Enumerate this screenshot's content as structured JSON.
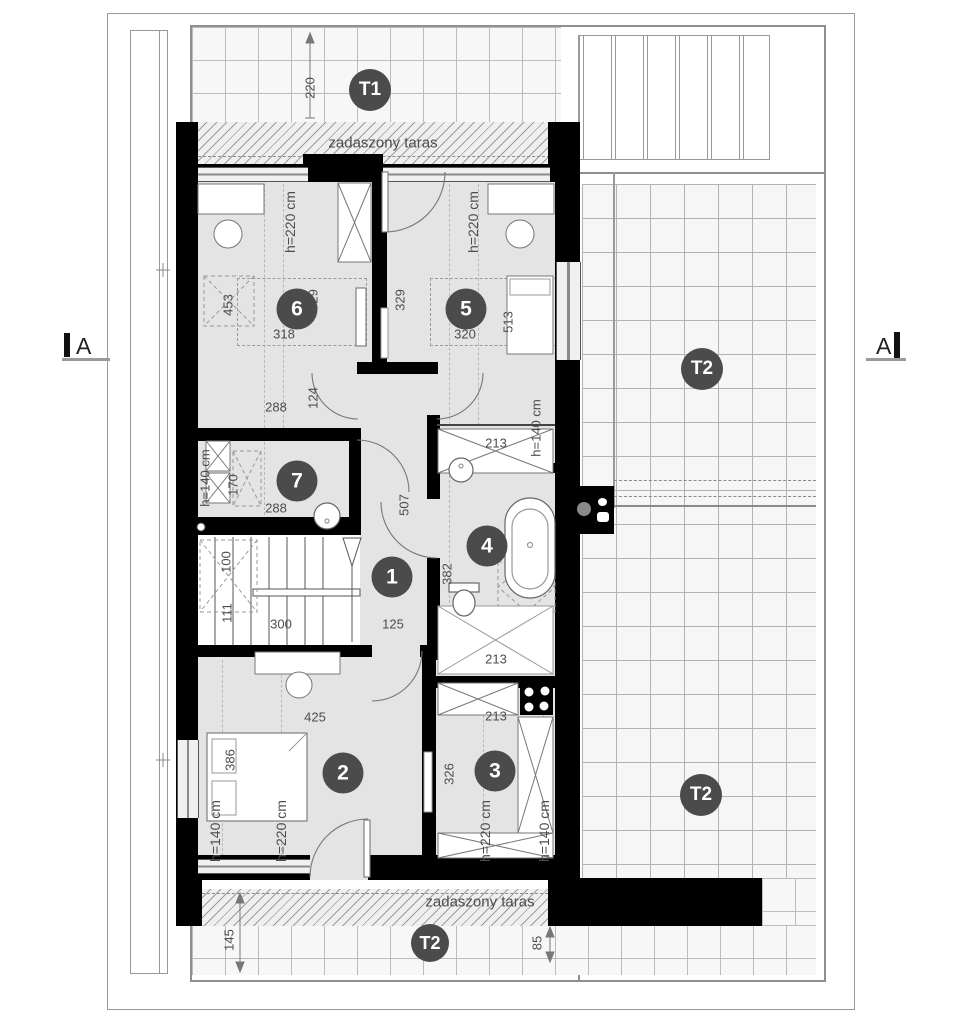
{
  "plan_title": "attic floor plan",
  "colors": {
    "wall": "#000000",
    "badge": "#4b4b4b",
    "dim_text": "#4d4d4d",
    "floor": "#e4e4e4",
    "terrace_grid": "#bcbcbc"
  },
  "section_markers": {
    "left": "A",
    "right": "A"
  },
  "badges": [
    {
      "n": "badge-terrace-t1",
      "t": "T1",
      "x": 370,
      "y": 90,
      "d": 42,
      "fs": 19
    },
    {
      "n": "badge-terrace-t2-upper",
      "t": "T2",
      "x": 702,
      "y": 369,
      "d": 42,
      "fs": 19
    },
    {
      "n": "badge-terrace-t2-lower",
      "t": "T2",
      "x": 701,
      "y": 795,
      "d": 42,
      "fs": 19
    },
    {
      "n": "badge-terrace-t2-bottom",
      "t": "T2",
      "x": 430,
      "y": 943,
      "d": 38,
      "fs": 18
    },
    {
      "n": "badge-room-1",
      "t": "1",
      "x": 392,
      "y": 577,
      "d": 41,
      "fs": 21
    },
    {
      "n": "badge-room-2",
      "t": "2",
      "x": 343,
      "y": 773,
      "d": 41,
      "fs": 21
    },
    {
      "n": "badge-room-3",
      "t": "3",
      "x": 495,
      "y": 771,
      "d": 41,
      "fs": 21
    },
    {
      "n": "badge-room-4",
      "t": "4",
      "x": 487,
      "y": 546,
      "d": 41,
      "fs": 21
    },
    {
      "n": "badge-room-5",
      "t": "5",
      "x": 466,
      "y": 309,
      "d": 41,
      "fs": 21
    },
    {
      "n": "badge-room-6",
      "t": "6",
      "x": 297,
      "y": 309,
      "d": 41,
      "fs": 21
    },
    {
      "n": "badge-room-7",
      "t": "7",
      "x": 297,
      "y": 481,
      "d": 41,
      "fs": 21
    }
  ],
  "texts": [
    {
      "n": "covered-terrace-label-top",
      "t": "zadaszony taras",
      "x": 383,
      "y": 143,
      "r": 0,
      "s": 15
    },
    {
      "n": "covered-terrace-label-bottom",
      "t": "zadaszony taras",
      "x": 480,
      "y": 902,
      "r": 0,
      "s": 15
    },
    {
      "n": "dim-terrace-depth",
      "t": "220",
      "x": 310,
      "y": 88,
      "r": -90,
      "s": 13
    },
    {
      "n": "dim-room6-height",
      "t": "h=220 cm",
      "x": 290,
      "y": 222,
      "r": -90,
      "s": 14
    },
    {
      "n": "dim-room5-height",
      "t": "h=220 cm",
      "x": 473,
      "y": 222,
      "r": -90,
      "s": 14
    },
    {
      "n": "dim-room6-depth",
      "t": "329",
      "x": 313,
      "y": 300,
      "r": -90,
      "s": 13
    },
    {
      "n": "dim-room5-depth",
      "t": "329",
      "x": 400,
      "y": 300,
      "r": -90,
      "s": 13
    },
    {
      "n": "dim-room6-skylight",
      "t": "453",
      "x": 228,
      "y": 305,
      "r": -90,
      "s": 13
    },
    {
      "n": "dim-room5-bed",
      "t": "513",
      "x": 508,
      "y": 322,
      "r": -90,
      "s": 13
    },
    {
      "n": "dim-room6-width",
      "t": "318",
      "x": 284,
      "y": 334,
      "r": 0,
      "s": 13
    },
    {
      "n": "dim-room5-width",
      "t": "320",
      "x": 465,
      "y": 334,
      "r": 0,
      "s": 13
    },
    {
      "n": "dim-hall-nook",
      "t": "124",
      "x": 313,
      "y": 398,
      "r": -90,
      "s": 13
    },
    {
      "n": "dim-room6-bottom",
      "t": "288",
      "x": 276,
      "y": 407,
      "r": 0,
      "s": 13
    },
    {
      "n": "dim-wardrobe-width",
      "t": "213",
      "x": 496,
      "y": 443,
      "r": 0,
      "s": 13
    },
    {
      "n": "dim-wardrobe-height",
      "t": "h=140 cm",
      "x": 536,
      "y": 428,
      "r": -90,
      "s": 13
    },
    {
      "n": "dim-room7-height",
      "t": "h=140 cm",
      "x": 205,
      "y": 478,
      "r": -90,
      "s": 13
    },
    {
      "n": "dim-room7-appliance",
      "t": "170",
      "x": 233,
      "y": 485,
      "r": -90,
      "s": 13
    },
    {
      "n": "dim-room7-width",
      "t": "288",
      "x": 276,
      "y": 508,
      "r": 0,
      "s": 13
    },
    {
      "n": "dim-hall-length",
      "t": "507",
      "x": 404,
      "y": 505,
      "r": -90,
      "s": 13
    },
    {
      "n": "dim-bath-depth",
      "t": "382",
      "x": 447,
      "y": 574,
      "r": -90,
      "s": 13
    },
    {
      "n": "dim-stairs-upper",
      "t": "100",
      "x": 226,
      "y": 562,
      "r": -90,
      "s": 13
    },
    {
      "n": "dim-stairs-lower",
      "t": "111",
      "x": 227,
      "y": 613,
      "r": -90,
      "s": 13
    },
    {
      "n": "dim-stairs-width",
      "t": "300",
      "x": 281,
      "y": 624,
      "r": 0,
      "s": 13
    },
    {
      "n": "dim-hall-width",
      "t": "125",
      "x": 393,
      "y": 624,
      "r": 0,
      "s": 13
    },
    {
      "n": "dim-bath-width",
      "t": "213",
      "x": 496,
      "y": 659,
      "r": 0,
      "s": 13
    },
    {
      "n": "dim-room3-width",
      "t": "213",
      "x": 496,
      "y": 716,
      "r": 0,
      "s": 13
    },
    {
      "n": "dim-room2-width",
      "t": "425",
      "x": 315,
      "y": 717,
      "r": 0,
      "s": 13
    },
    {
      "n": "dim-room2-bed",
      "t": "386",
      "x": 230,
      "y": 760,
      "r": -90,
      "s": 13
    },
    {
      "n": "dim-room3-depth",
      "t": "326",
      "x": 449,
      "y": 774,
      "r": -90,
      "s": 13
    },
    {
      "n": "dim-room2-h140",
      "t": "h=140 cm",
      "x": 215,
      "y": 831,
      "r": -90,
      "s": 14
    },
    {
      "n": "dim-room2-h220",
      "t": "h=220 cm",
      "x": 281,
      "y": 831,
      "r": -90,
      "s": 14
    },
    {
      "n": "dim-room3-h220",
      "t": "h=220 cm",
      "x": 485,
      "y": 831,
      "r": -90,
      "s": 14
    },
    {
      "n": "dim-room3-h140",
      "t": "h=140 cm",
      "x": 544,
      "y": 831,
      "r": -90,
      "s": 14
    },
    {
      "n": "dim-bottom-terrace",
      "t": "145",
      "x": 229,
      "y": 940,
      "r": -90,
      "s": 13
    },
    {
      "n": "dim-bottom-offset",
      "t": "85",
      "x": 537,
      "y": 943,
      "r": -90,
      "s": 13
    }
  ]
}
